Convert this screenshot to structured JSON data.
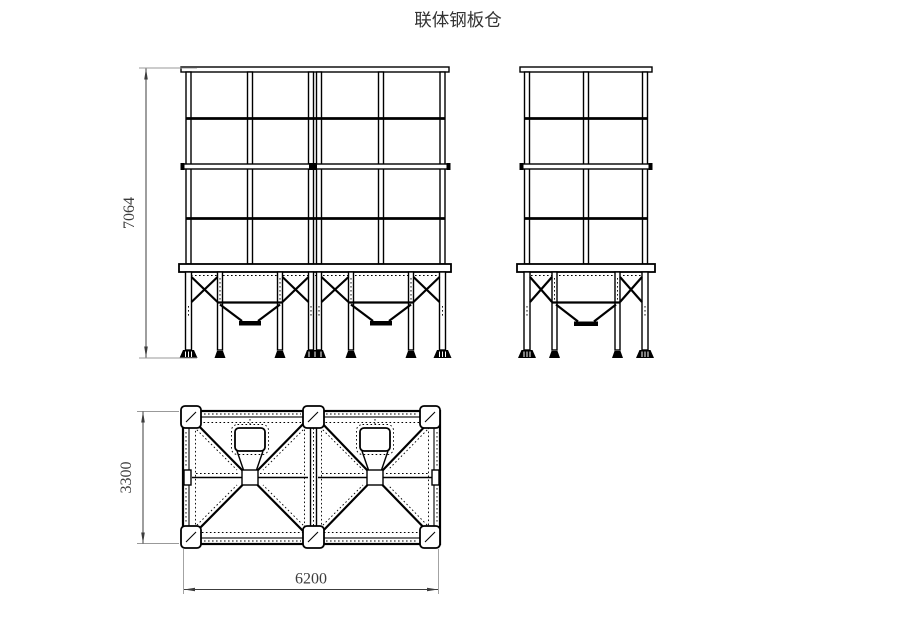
{
  "title": {
    "text": "联体钢板仓"
  },
  "dimensions": {
    "front_height": "7064",
    "plan_depth": "3300",
    "plan_width": "6200"
  },
  "colors": {
    "line": "#000000",
    "background": "#ffffff",
    "dimension": "#3c3c3c",
    "extension": "#999999"
  }
}
